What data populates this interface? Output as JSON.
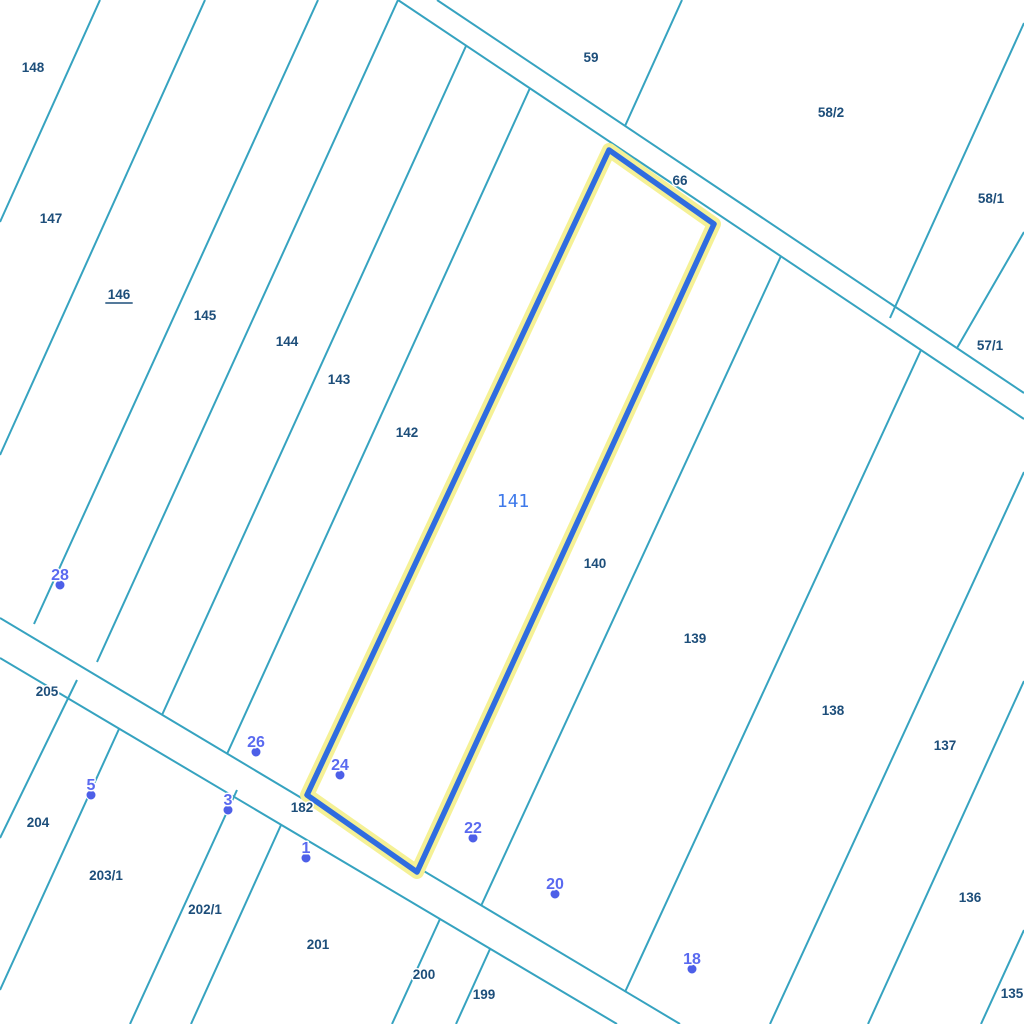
{
  "map": {
    "width": 1024,
    "height": 1024,
    "background": "#ffffff",
    "boundary_color": "#36a3c0",
    "boundary_width": 2,
    "parcel_label_color": "#1d4e7a",
    "boundary_lines": [
      [
        100,
        0,
        0,
        222
      ],
      [
        205,
        0,
        0,
        455
      ],
      [
        318,
        0,
        34,
        624
      ],
      [
        398,
        0,
        97,
        662
      ],
      [
        466,
        46,
        162,
        715
      ],
      [
        530,
        88,
        227,
        754
      ],
      [
        398,
        0,
        1024,
        419
      ],
      [
        437,
        0,
        1024,
        393
      ],
      [
        682,
        0,
        625,
        126
      ],
      [
        1024,
        23,
        890,
        318
      ],
      [
        1024,
        232,
        957,
        348
      ],
      [
        0,
        618,
        680,
        1024
      ],
      [
        0,
        658,
        617,
        1024
      ],
      [
        77,
        680,
        0,
        838
      ],
      [
        119,
        729,
        0,
        990
      ],
      [
        237,
        790,
        130,
        1024
      ],
      [
        281,
        825,
        191,
        1024
      ],
      [
        440,
        919,
        392,
        1024
      ],
      [
        490,
        949,
        456,
        1024
      ],
      [
        781,
        256,
        481,
        906
      ],
      [
        921,
        350,
        625,
        992
      ],
      [
        1024,
        472,
        770,
        1024
      ],
      [
        1024,
        681,
        868,
        1024
      ],
      [
        1024,
        930,
        981,
        1024
      ]
    ],
    "parcel_labels": [
      {
        "text": "148",
        "x": 33,
        "y": 67
      },
      {
        "text": "147",
        "x": 51,
        "y": 218
      },
      {
        "text": "146",
        "x": 119,
        "y": 294,
        "underline": true
      },
      {
        "text": "145",
        "x": 205,
        "y": 315
      },
      {
        "text": "144",
        "x": 287,
        "y": 341
      },
      {
        "text": "143",
        "x": 339,
        "y": 379
      },
      {
        "text": "142",
        "x": 407,
        "y": 432
      },
      {
        "text": "140",
        "x": 595,
        "y": 563
      },
      {
        "text": "139",
        "x": 695,
        "y": 638
      },
      {
        "text": "138",
        "x": 833,
        "y": 710
      },
      {
        "text": "137",
        "x": 945,
        "y": 745
      },
      {
        "text": "136",
        "x": 970,
        "y": 897
      },
      {
        "text": "135",
        "x": 1012,
        "y": 993
      },
      {
        "text": "59",
        "x": 591,
        "y": 57
      },
      {
        "text": "66",
        "x": 680,
        "y": 180
      },
      {
        "text": "58/2",
        "x": 831,
        "y": 112
      },
      {
        "text": "58/1",
        "x": 991,
        "y": 198
      },
      {
        "text": "57/1",
        "x": 990,
        "y": 345
      },
      {
        "text": "205",
        "x": 47,
        "y": 691
      },
      {
        "text": "204",
        "x": 38,
        "y": 822
      },
      {
        "text": "203/1",
        "x": 106,
        "y": 875
      },
      {
        "text": "202/1",
        "x": 205,
        "y": 909
      },
      {
        "text": "201",
        "x": 318,
        "y": 944
      },
      {
        "text": "200",
        "x": 424,
        "y": 974
      },
      {
        "text": "199",
        "x": 484,
        "y": 994
      },
      {
        "text": "182",
        "x": 302,
        "y": 807
      }
    ],
    "selected_parcel": {
      "number": "141",
      "label_color": "#3e79ea",
      "label_pos": {
        "x": 513,
        "y": 501
      },
      "outline_color": "#2f6ce0",
      "outline_width": 5.5,
      "halo_color": "#f5f196",
      "halo_width": 14,
      "polygon": [
        [
          609,
          150
        ],
        [
          714,
          224
        ],
        [
          417,
          872
        ],
        [
          307,
          795
        ]
      ]
    },
    "address_points": {
      "color": "#5a6af0",
      "dot_color": "#4d5fe8",
      "halo_color": "#ffffff",
      "dot_radius": 5,
      "markers": [
        {
          "text": "28",
          "x": 60,
          "y": 575
        },
        {
          "text": "26",
          "x": 256,
          "y": 742
        },
        {
          "text": "24",
          "x": 340,
          "y": 765
        },
        {
          "text": "22",
          "x": 473,
          "y": 828
        },
        {
          "text": "20",
          "x": 555,
          "y": 884
        },
        {
          "text": "18",
          "x": 692,
          "y": 959
        },
        {
          "text": "5",
          "x": 91,
          "y": 785
        },
        {
          "text": "3",
          "x": 228,
          "y": 800
        },
        {
          "text": "1",
          "x": 306,
          "y": 848
        }
      ]
    }
  }
}
